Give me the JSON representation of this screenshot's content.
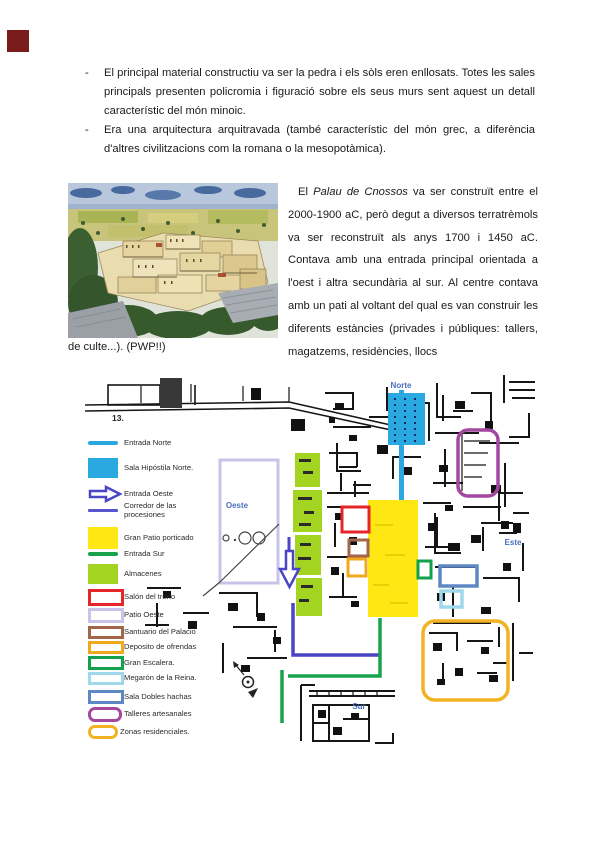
{
  "page": {
    "corner_mark_color": "#7a1c1c"
  },
  "bullets": {
    "marker": "-",
    "items": [
      "El principal material constructiu va ser la pedra i els sòls eren enllosats. Totes les sales principals presenten policromia i figuració sobre els seus murs sent aquest un detall característic del món minoic.",
      "Era una arquitectura arquitravada (també característic del món grec, a diferència d'altres civilitzacions com la romana o la mesopotàmica)."
    ]
  },
  "article": {
    "lead": "El ",
    "italic": "Palau de Cnossos",
    "rest": " va ser construït entre el 2000-1900 aC, però degut a diversos terratrèmols va ser reconstruït als anys 1700 i 1450 aC. Contava amb una entrada principal orientada a l'oest i altra secundària al sur.  Al centre contava amb un pati al voltant del qual es van construir les diferents estàncies (privades i públiques: tallers, magatzems, residències, llocs",
    "continuation": "de culte...). (PWP!!)"
  },
  "map": {
    "legend_number": "13.",
    "labels": {
      "norte": "Norte",
      "este": "Este",
      "sur": "Sur",
      "oeste": "Oeste"
    },
    "legend": [
      {
        "label": "Entrada Norte",
        "swatch": "line",
        "color": "#2aa9e0"
      },
      {
        "label": "Sala Hipóstila Norte.",
        "swatch": "fill",
        "color": "#2aa9e0"
      },
      {
        "label": "Entrada Oeste",
        "swatch": "arrow",
        "color": "#4a45c4"
      },
      {
        "label": "Corredor de las procesiones",
        "swatch": "line",
        "color": "#5a55cc"
      },
      {
        "label": "Gran Patio porticado",
        "swatch": "fill",
        "color": "#ffe713"
      },
      {
        "label": "Entrada Sur",
        "swatch": "line",
        "color": "#18a24c"
      },
      {
        "label": "Almacenes",
        "swatch": "fill",
        "color": "#a4d422"
      },
      {
        "label": "Salón del trono",
        "swatch": "outline",
        "color": "#e52528"
      },
      {
        "label": "Patio Oeste",
        "swatch": "outline",
        "color": "#c7c3e9"
      },
      {
        "label": "Santuario del Palacio",
        "swatch": "outline",
        "color": "#a3664a"
      },
      {
        "label": "Deposito de ofrendas",
        "swatch": "outline",
        "color": "#f0a81c"
      },
      {
        "label": "Gran Escalera.",
        "swatch": "outline",
        "color": "#13a14e"
      },
      {
        "label": "Megarón de la Reina.",
        "swatch": "outline",
        "color": "#9fd8ea"
      },
      {
        "label": "Sala Dobles hachas",
        "swatch": "outline",
        "color": "#5e88c4"
      },
      {
        "label": "Talleres artesanales",
        "swatch": "outline-rounded",
        "color": "#a2489e"
      },
      {
        "label": "Zonas residenciales.",
        "swatch": "outline-rounded",
        "color": "#f2b222"
      }
    ]
  }
}
